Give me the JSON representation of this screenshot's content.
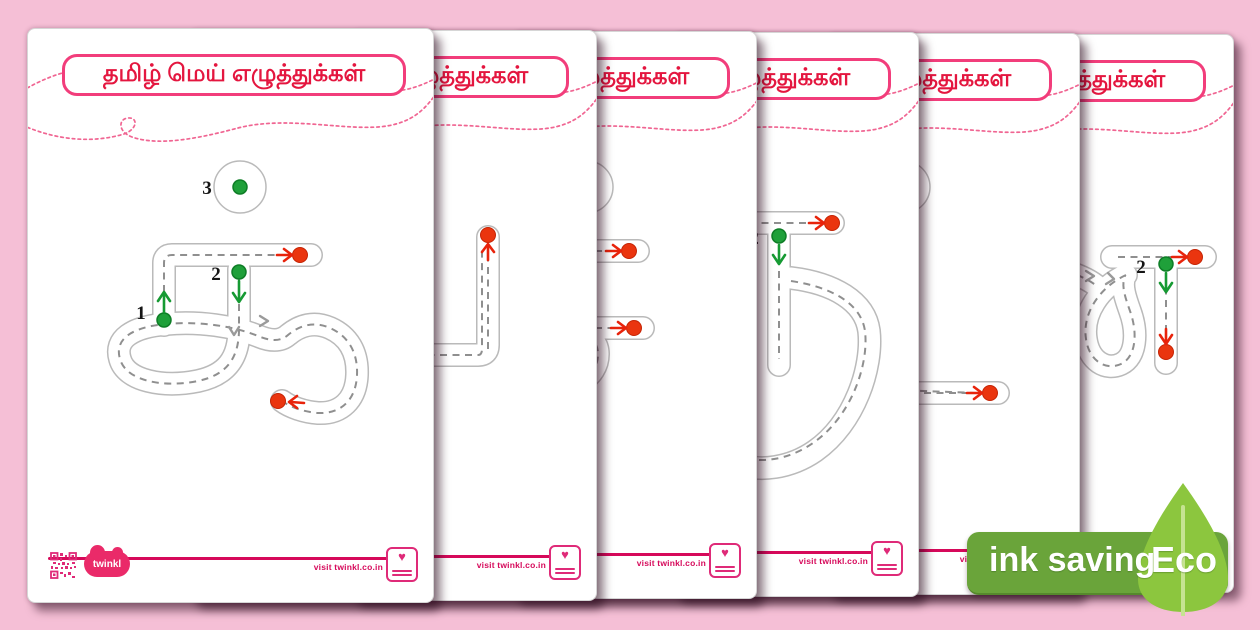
{
  "background_color": "#f5bfd6",
  "shared": {
    "title": "தமிழ் மெய் எழுத்துக்கள்",
    "visit_text": "visit twinkl.co.in",
    "brand": "twinkl",
    "title_text_color": "#e4163f",
    "title_border_color": "#f23d7b",
    "footer_line_color": "#d6095a",
    "brand_pink": "#df2a78"
  },
  "trace_style": {
    "track_outline_gray": "#bababa",
    "trace_dash_gray": "#8f8f8f",
    "start_dot_green": "#1fa03a",
    "end_dot_red": "#ea350f"
  },
  "pages": [
    {
      "name": "worksheet-ka",
      "letter": "க்",
      "steps": {
        "s1": "1",
        "s2": "2",
        "s3": "3"
      }
    },
    {
      "name": "worksheet-nga",
      "letter": "ங்",
      "steps": {}
    },
    {
      "name": "worksheet-ca",
      "letter": "ச்",
      "steps": {}
    },
    {
      "name": "worksheet-nya",
      "letter": "ஞ்",
      "steps": {
        "s2": "2"
      }
    },
    {
      "name": "worksheet-tta",
      "letter": "ட்",
      "steps": {}
    },
    {
      "name": "worksheet-nna",
      "letter": "ண்",
      "steps": {
        "s2": "2"
      }
    }
  ],
  "eco_badge": {
    "label": "ink saving",
    "eco": "Eco",
    "badge_color": "#6aa43a",
    "leaf_color": "#8cc63e"
  }
}
